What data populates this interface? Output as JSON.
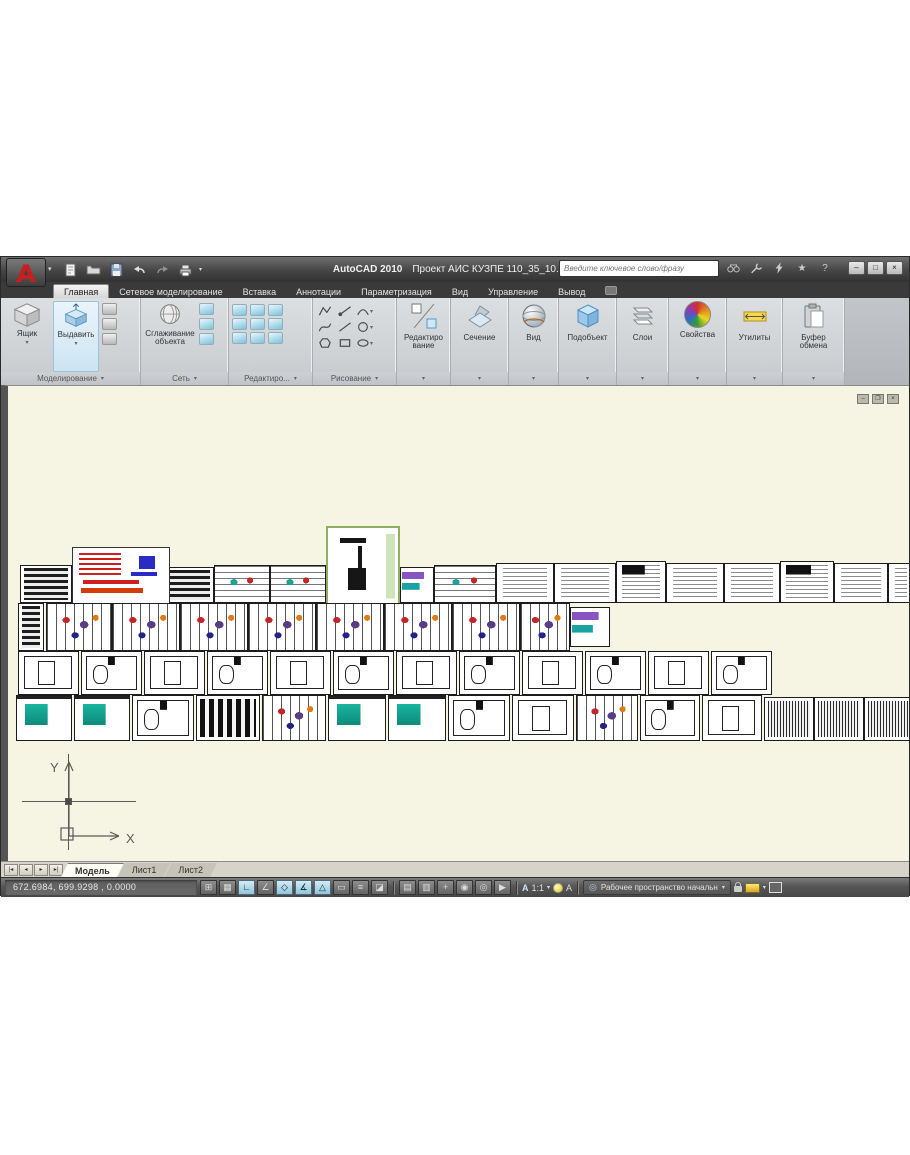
{
  "window": {
    "app_title": "AutoCAD 2010",
    "doc_title": "Проект АИС КУЗПЕ 110_35_10.dwg",
    "search_placeholder": "Введите ключевое слово/фразу",
    "qat_icons": [
      "new",
      "open",
      "save",
      "undo",
      "redo",
      "plot"
    ],
    "infocenter_icons": [
      "search",
      "wrench",
      "communication",
      "favorites",
      "help"
    ],
    "favorites_glyph": "★",
    "help_glyph": "?",
    "window_buttons": {
      "minimize": "–",
      "maximize": "□",
      "close": "×"
    }
  },
  "ribbon": {
    "tabs": [
      {
        "label": "Главная",
        "active": true
      },
      {
        "label": "Сетевое моделирование",
        "active": false
      },
      {
        "label": "Вставка",
        "active": false
      },
      {
        "label": "Аннотации",
        "active": false
      },
      {
        "label": "Параметризация",
        "active": false
      },
      {
        "label": "Вид",
        "active": false
      },
      {
        "label": "Управление",
        "active": false
      },
      {
        "label": "Вывод",
        "active": false
      }
    ],
    "panels": {
      "modeling": {
        "label": "Моделирование",
        "buttons": [
          {
            "label": "Ящик"
          },
          {
            "label": "Выдавить"
          }
        ],
        "small_icons": [
          "polysolid",
          "sweep",
          "loft"
        ]
      },
      "mesh": {
        "label": "Сеть",
        "button_label": "Сглаживание объекта",
        "small_icons": [
          "mesh-refine",
          "mesh-add-crease",
          "mesh-smooth-less"
        ]
      },
      "solidedit": {
        "label": "Редактиро...",
        "icons": [
          "union",
          "subtract",
          "intersect",
          "extrude-face",
          "move-face",
          "offset-face",
          "shell",
          "imprint",
          "separate"
        ]
      },
      "draw": {
        "label": "Рисование",
        "icons": [
          "polyline",
          "ray",
          "arc",
          "spline",
          "line",
          "circle",
          "polygon",
          "rectangle",
          "ellipse"
        ]
      },
      "modify": {
        "label": "Редактиро вание"
      },
      "section": {
        "label": "Сечение"
      },
      "view": {
        "label": "Вид"
      },
      "subobject": {
        "label": "Подобъект"
      },
      "layers": {
        "label": "Слои"
      },
      "properties": {
        "label": "Свойства"
      },
      "utilities": {
        "label": "Утилиты"
      },
      "clipboard": {
        "label": "Буфер обмена"
      }
    }
  },
  "canvas": {
    "ucs": {
      "x_label": "X",
      "y_label": "Y"
    },
    "window_buttons": {
      "minimize": "–",
      "restore": "❐",
      "close": "×"
    },
    "sheets": [
      {
        "x": 12,
        "y": 179,
        "w": 52,
        "h": 38,
        "s": "dtable"
      },
      {
        "x": 64,
        "y": 179,
        "w": 52,
        "h": 38,
        "s": "dtable"
      },
      {
        "x": 116,
        "y": 181,
        "w": 38,
        "h": 36,
        "s": "dtable"
      },
      {
        "x": 154,
        "y": 181,
        "w": 52,
        "h": 36,
        "s": "dtable"
      },
      {
        "x": 206,
        "y": 179,
        "w": 56,
        "h": 38,
        "s": "color2"
      },
      {
        "x": 262,
        "y": 179,
        "w": 56,
        "h": 38,
        "s": "color2"
      },
      {
        "x": 392,
        "y": 181,
        "w": 34,
        "h": 36,
        "s": "purple"
      },
      {
        "x": 426,
        "y": 179,
        "w": 62,
        "h": 38,
        "s": "color2"
      },
      {
        "x": 488,
        "y": 177,
        "w": 58,
        "h": 40,
        "s": "wtable"
      },
      {
        "x": 546,
        "y": 177,
        "w": 62,
        "h": 40,
        "s": "wtable"
      },
      {
        "x": 608,
        "y": 175,
        "w": 50,
        "h": 42,
        "s": "wtable2"
      },
      {
        "x": 658,
        "y": 177,
        "w": 58,
        "h": 40,
        "s": "wtable"
      },
      {
        "x": 716,
        "y": 177,
        "w": 56,
        "h": 40,
        "s": "wtable"
      },
      {
        "x": 772,
        "y": 175,
        "w": 54,
        "h": 42,
        "s": "wtable2"
      },
      {
        "x": 826,
        "y": 177,
        "w": 54,
        "h": 40,
        "s": "wtable"
      },
      {
        "x": 880,
        "y": 177,
        "w": 26,
        "h": 40,
        "s": "wtable"
      },
      {
        "x": 64,
        "y": 161,
        "w": 98,
        "h": 58,
        "s": "red"
      },
      {
        "x": 318,
        "y": 140,
        "w": 74,
        "h": 79,
        "s": "green"
      },
      {
        "x": 10,
        "y": 217,
        "w": 26,
        "h": 48,
        "s": "dtable"
      },
      {
        "x": 38,
        "y": 217,
        "w": 66,
        "h": 48,
        "s": "color"
      },
      {
        "x": 104,
        "y": 217,
        "w": 68,
        "h": 48,
        "s": "color"
      },
      {
        "x": 172,
        "y": 217,
        "w": 68,
        "h": 48,
        "s": "color"
      },
      {
        "x": 240,
        "y": 217,
        "w": 68,
        "h": 48,
        "s": "color"
      },
      {
        "x": 308,
        "y": 217,
        "w": 68,
        "h": 48,
        "s": "color"
      },
      {
        "x": 376,
        "y": 217,
        "w": 68,
        "h": 48,
        "s": "color"
      },
      {
        "x": 444,
        "y": 217,
        "w": 68,
        "h": 48,
        "s": "color"
      },
      {
        "x": 512,
        "y": 217,
        "w": 50,
        "h": 48,
        "s": "color"
      },
      {
        "x": 562,
        "y": 221,
        "w": 40,
        "h": 40,
        "s": "purple"
      },
      {
        "x": 10,
        "y": 265,
        "w": 61,
        "h": 44,
        "s": "plan"
      },
      {
        "x": 73,
        "y": 265,
        "w": 61,
        "h": 44,
        "s": "plan2"
      },
      {
        "x": 136,
        "y": 265,
        "w": 61,
        "h": 44,
        "s": "plan"
      },
      {
        "x": 199,
        "y": 265,
        "w": 61,
        "h": 44,
        "s": "plan2"
      },
      {
        "x": 262,
        "y": 265,
        "w": 61,
        "h": 44,
        "s": "plan"
      },
      {
        "x": 325,
        "y": 265,
        "w": 61,
        "h": 44,
        "s": "plan2"
      },
      {
        "x": 388,
        "y": 265,
        "w": 61,
        "h": 44,
        "s": "plan"
      },
      {
        "x": 451,
        "y": 265,
        "w": 61,
        "h": 44,
        "s": "plan2"
      },
      {
        "x": 514,
        "y": 265,
        "w": 61,
        "h": 44,
        "s": "plan"
      },
      {
        "x": 577,
        "y": 265,
        "w": 61,
        "h": 44,
        "s": "plan2"
      },
      {
        "x": 640,
        "y": 265,
        "w": 61,
        "h": 44,
        "s": "plan"
      },
      {
        "x": 703,
        "y": 265,
        "w": 61,
        "h": 44,
        "s": "plan2"
      },
      {
        "x": 8,
        "y": 309,
        "w": 56,
        "h": 46,
        "s": "teal"
      },
      {
        "x": 66,
        "y": 309,
        "w": 56,
        "h": 46,
        "s": "teal"
      },
      {
        "x": 124,
        "y": 309,
        "w": 62,
        "h": 46,
        "s": "plan2"
      },
      {
        "x": 188,
        "y": 309,
        "w": 64,
        "h": 46,
        "s": "dark"
      },
      {
        "x": 254,
        "y": 309,
        "w": 64,
        "h": 46,
        "s": "color"
      },
      {
        "x": 320,
        "y": 309,
        "w": 58,
        "h": 46,
        "s": "teal"
      },
      {
        "x": 380,
        "y": 309,
        "w": 58,
        "h": 46,
        "s": "teal"
      },
      {
        "x": 440,
        "y": 309,
        "w": 62,
        "h": 46,
        "s": "plan2"
      },
      {
        "x": 504,
        "y": 309,
        "w": 62,
        "h": 46,
        "s": "plan"
      },
      {
        "x": 568,
        "y": 309,
        "w": 62,
        "h": 46,
        "s": "color"
      },
      {
        "x": 632,
        "y": 309,
        "w": 60,
        "h": 46,
        "s": "plan2"
      },
      {
        "x": 694,
        "y": 309,
        "w": 60,
        "h": 46,
        "s": "plan"
      },
      {
        "x": 756,
        "y": 311,
        "w": 50,
        "h": 44,
        "s": "hatch"
      },
      {
        "x": 806,
        "y": 311,
        "w": 50,
        "h": 44,
        "s": "hatch"
      },
      {
        "x": 856,
        "y": 311,
        "w": 50,
        "h": 44,
        "s": "hatch"
      }
    ]
  },
  "layout_tabs": {
    "nav_glyphs": [
      "|◂",
      "◂",
      "▸",
      "▸|"
    ],
    "items": [
      {
        "label": "Модель",
        "active": true
      },
      {
        "label": "Лист1",
        "active": false
      },
      {
        "label": "Лист2",
        "active": false
      }
    ]
  },
  "statusbar": {
    "coords": "672.6984, 699.9298 , 0.0000",
    "toggles": [
      {
        "name": "snap",
        "glyph": "⊞",
        "on": false
      },
      {
        "name": "grid",
        "glyph": "▦",
        "on": false
      },
      {
        "name": "ortho",
        "glyph": "∟",
        "on": true
      },
      {
        "name": "polar",
        "glyph": "∠",
        "on": false
      },
      {
        "name": "osnap",
        "glyph": "◇",
        "on": true
      },
      {
        "name": "otrack",
        "glyph": "∡",
        "on": true
      },
      {
        "name": "ducs",
        "glyph": "△",
        "on": true
      },
      {
        "name": "dyn",
        "glyph": "▭",
        "on": false
      },
      {
        "name": "lwt",
        "glyph": "≡",
        "on": false
      },
      {
        "name": "qp",
        "glyph": "◪",
        "on": false
      }
    ],
    "quick_icons": [
      {
        "name": "quickview-layouts",
        "glyph": "▤"
      },
      {
        "name": "quickview-drawings",
        "glyph": "▥"
      },
      {
        "name": "pan",
        "glyph": "+"
      },
      {
        "name": "zoom",
        "glyph": "◉"
      },
      {
        "name": "steering-wheel",
        "glyph": "◎"
      },
      {
        "name": "show-motion",
        "glyph": "▶"
      }
    ],
    "annotation_letter": "А",
    "annotation_scale": "1:1",
    "workspace_label": "Рабочее пространство начальн"
  }
}
